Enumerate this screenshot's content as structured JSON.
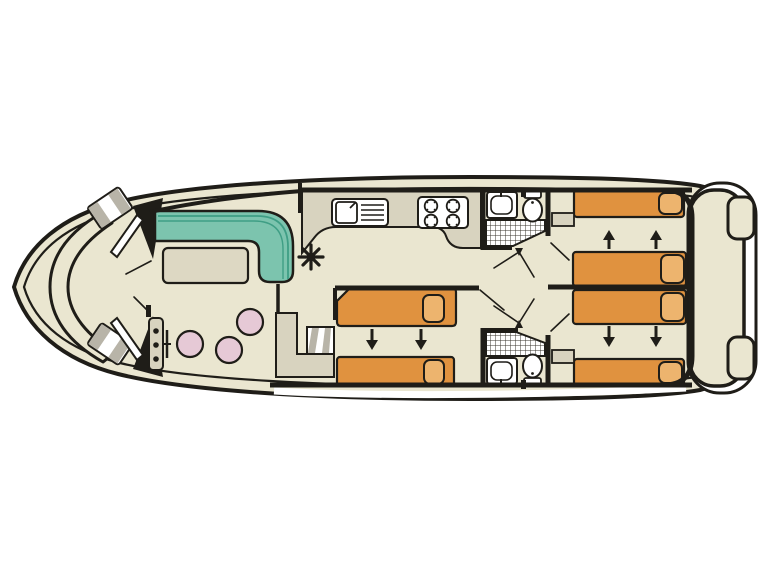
{
  "page": {
    "background": "#ffffff"
  },
  "plan": {
    "type": "boat-deck-plan",
    "orientation": "bow-left",
    "asterisk_symbol": "✳",
    "areas": [
      {
        "id": "bow-deck",
        "furniture": [
          "curved-bench",
          "side-step",
          "side-step",
          "door",
          "door"
        ]
      },
      {
        "id": "saloon",
        "furniture": [
          "l-shaped-sofa",
          "table",
          "stool",
          "stool",
          "stool",
          "helm-console",
          "steering-wheel"
        ]
      },
      {
        "id": "galley",
        "furniture": [
          "counter",
          "sink-with-drainer",
          "hob-4-burner",
          "asterisk-symbol"
        ]
      },
      {
        "id": "mid-cabin",
        "furniture": [
          "single-bed",
          "single-bed",
          "companionway-steps",
          "wardrobe-unit"
        ],
        "bed_slide_arrows": "down"
      },
      {
        "id": "bathroom-top",
        "furniture": [
          "washbasin",
          "toilet",
          "shower"
        ]
      },
      {
        "id": "bathroom-bottom",
        "furniture": [
          "shower",
          "washbasin",
          "toilet"
        ]
      },
      {
        "id": "aft-cabin-top",
        "furniture": [
          "single-bed",
          "single-bed",
          "cabinet"
        ],
        "bed_slide_arrows": "up"
      },
      {
        "id": "aft-cabin-bottom",
        "furniture": [
          "single-bed",
          "single-bed",
          "cabinet"
        ],
        "bed_slide_arrows": "down"
      },
      {
        "id": "stern-deck",
        "furniture": [
          "step",
          "step",
          "swim-platform"
        ]
      }
    ],
    "counts": {
      "single_beds": 6,
      "stools": 3,
      "showers": 2,
      "toilets": 2,
      "washbasins": 2,
      "hob_burners": 4,
      "slide_arrows": 8
    }
  },
  "colors": {
    "page_bg": "#ffffff",
    "hull_fill": "#eae6d0",
    "line": "#1f1d18",
    "sofa_teal": "#7cc4ae",
    "sofa_line": "#3f9e85",
    "table_fill": "#ddd8c3",
    "counter_fill": "#d8d3bf",
    "bed_fill": "#e0923f",
    "pillow_fill": "#edb46e",
    "stool_fill": "#e6c9d6",
    "step_gray": "#b8b4a8",
    "fixture_fill": "#ffffff",
    "deck_white": "#ffffff"
  }
}
